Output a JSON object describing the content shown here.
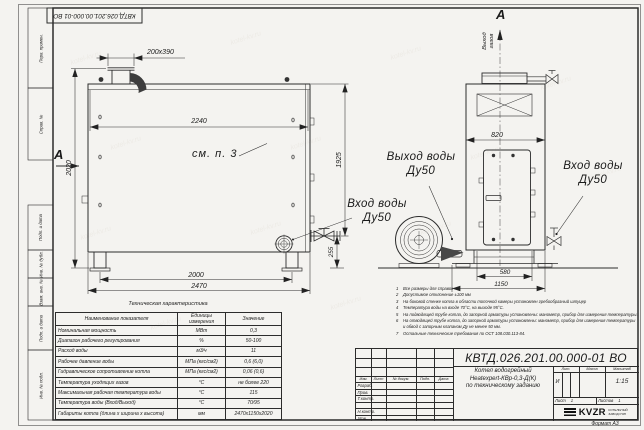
{
  "watermark": "kotel-kv.ru",
  "frame": {
    "stamp_top": "КВТД.026.201.00.000-01 ВО",
    "format_note": "Формат А3",
    "side_strip": [
      "Перв. примен.",
      "Справ. №",
      "Подп. и дата",
      "Инв. № дубл.",
      "Взам. инв. №",
      "Подп. и дата",
      "Инв. № подл."
    ]
  },
  "front_view": {
    "section_mark": "А",
    "nozzle_dim": "200х390",
    "top_width": "2240",
    "height_left": "2020",
    "height_right": "1925",
    "outlet_height": "255",
    "feet_span": "2000",
    "overall_width": "2470",
    "see_note": "см. п. 3",
    "inlet_label": "Вход воды",
    "inlet_dn": "Ду50"
  },
  "side_view": {
    "section_mark": "А",
    "gas_outlet_line1": "Выход",
    "gas_outlet_line2": "газов",
    "top_width": "820",
    "feet_span": "580",
    "overall_depth": "1150",
    "outlet_label": "Выход воды",
    "outlet_dn": "Ду50",
    "inlet_label": "Вход воды",
    "inlet_dn": "Ду50"
  },
  "notes": [
    {
      "num": "1",
      "text": "Все размеры для справок"
    },
    {
      "num": "2",
      "text": "Допустимое отклонение ±100 мм"
    },
    {
      "num": "3",
      "text": "На боковой стенке котла в области топочной камеры установлен гребообразный штуцер"
    },
    {
      "num": "4",
      "text": "Температура воды на входе 70°С, на выходе 95°С."
    },
    {
      "num": "5",
      "text": "На подводящей трубе котла, до запорной арматуры установлены: манометр, прибор для измерения температуры."
    },
    {
      "num": "6",
      "text": "На отводящей трубе котла, до запорной арматуры установлены: манометр, прибор для измерения температуры и обвод с запорным клапаном Ду не менее 50 мм."
    },
    {
      "num": "7",
      "text": "Остальные технические требования по ОСТ 108.030.113-84."
    }
  ],
  "tech_table": {
    "title": "Техническая характеристика",
    "headers": [
      "Наименование показателя",
      "Единицы измерения",
      "Значение"
    ],
    "rows": [
      [
        "Номинальная мощность",
        "МВт",
        "0,3"
      ],
      [
        "Диапазон рабочего регулирования",
        "%",
        "50-100"
      ],
      [
        "Расход воды",
        "м3/ч",
        "11"
      ],
      [
        "Рабочее давление воды",
        "МПа (кгс/см2)",
        "0,6 (6,0)"
      ],
      [
        "Гидравлическое сопротивление котла",
        "МПа (кгс/см2)",
        "0,06 (0,6)"
      ],
      [
        "Температура уходящих газов",
        "°С",
        "не более 220"
      ],
      [
        "Максимальная рабочая температура воды",
        "°С",
        "115"
      ],
      [
        "Температура воды (Вход/Выход)",
        "°С",
        "70/95"
      ],
      [
        "Габариты котла (длина х ширина х высота)",
        "мм",
        "2470х1150х2020"
      ]
    ]
  },
  "title_block": {
    "doc_number": "КВТД.026.201.00.000-01 ВО",
    "name_line1": "Котел водогрейный",
    "name_line2": "Heatexpert-КВр-0,3-Д(К)",
    "name_line3": "по техническому заданию",
    "header_cells": [
      "Изм.",
      "Лист",
      "№ докум.",
      "Подп.",
      "Дата"
    ],
    "row_labels": [
      "Разраб.",
      "Пров.",
      "Т.контр.",
      "Н.контр.",
      "Утв."
    ],
    "lit_header": "Лит.",
    "mass_header": "Масса",
    "scale_header": "Масштаб",
    "lit_value": "И",
    "scale_value": "1:15",
    "sheet_label": "Лист",
    "sheet_value": "1",
    "sheets_label": "Листов",
    "sheets_value": "1",
    "logo_text": "KVZR",
    "logo_sub1": "КОТЕЛЬНЫЙ",
    "logo_sub2": "ЗАВОД РЭП"
  }
}
